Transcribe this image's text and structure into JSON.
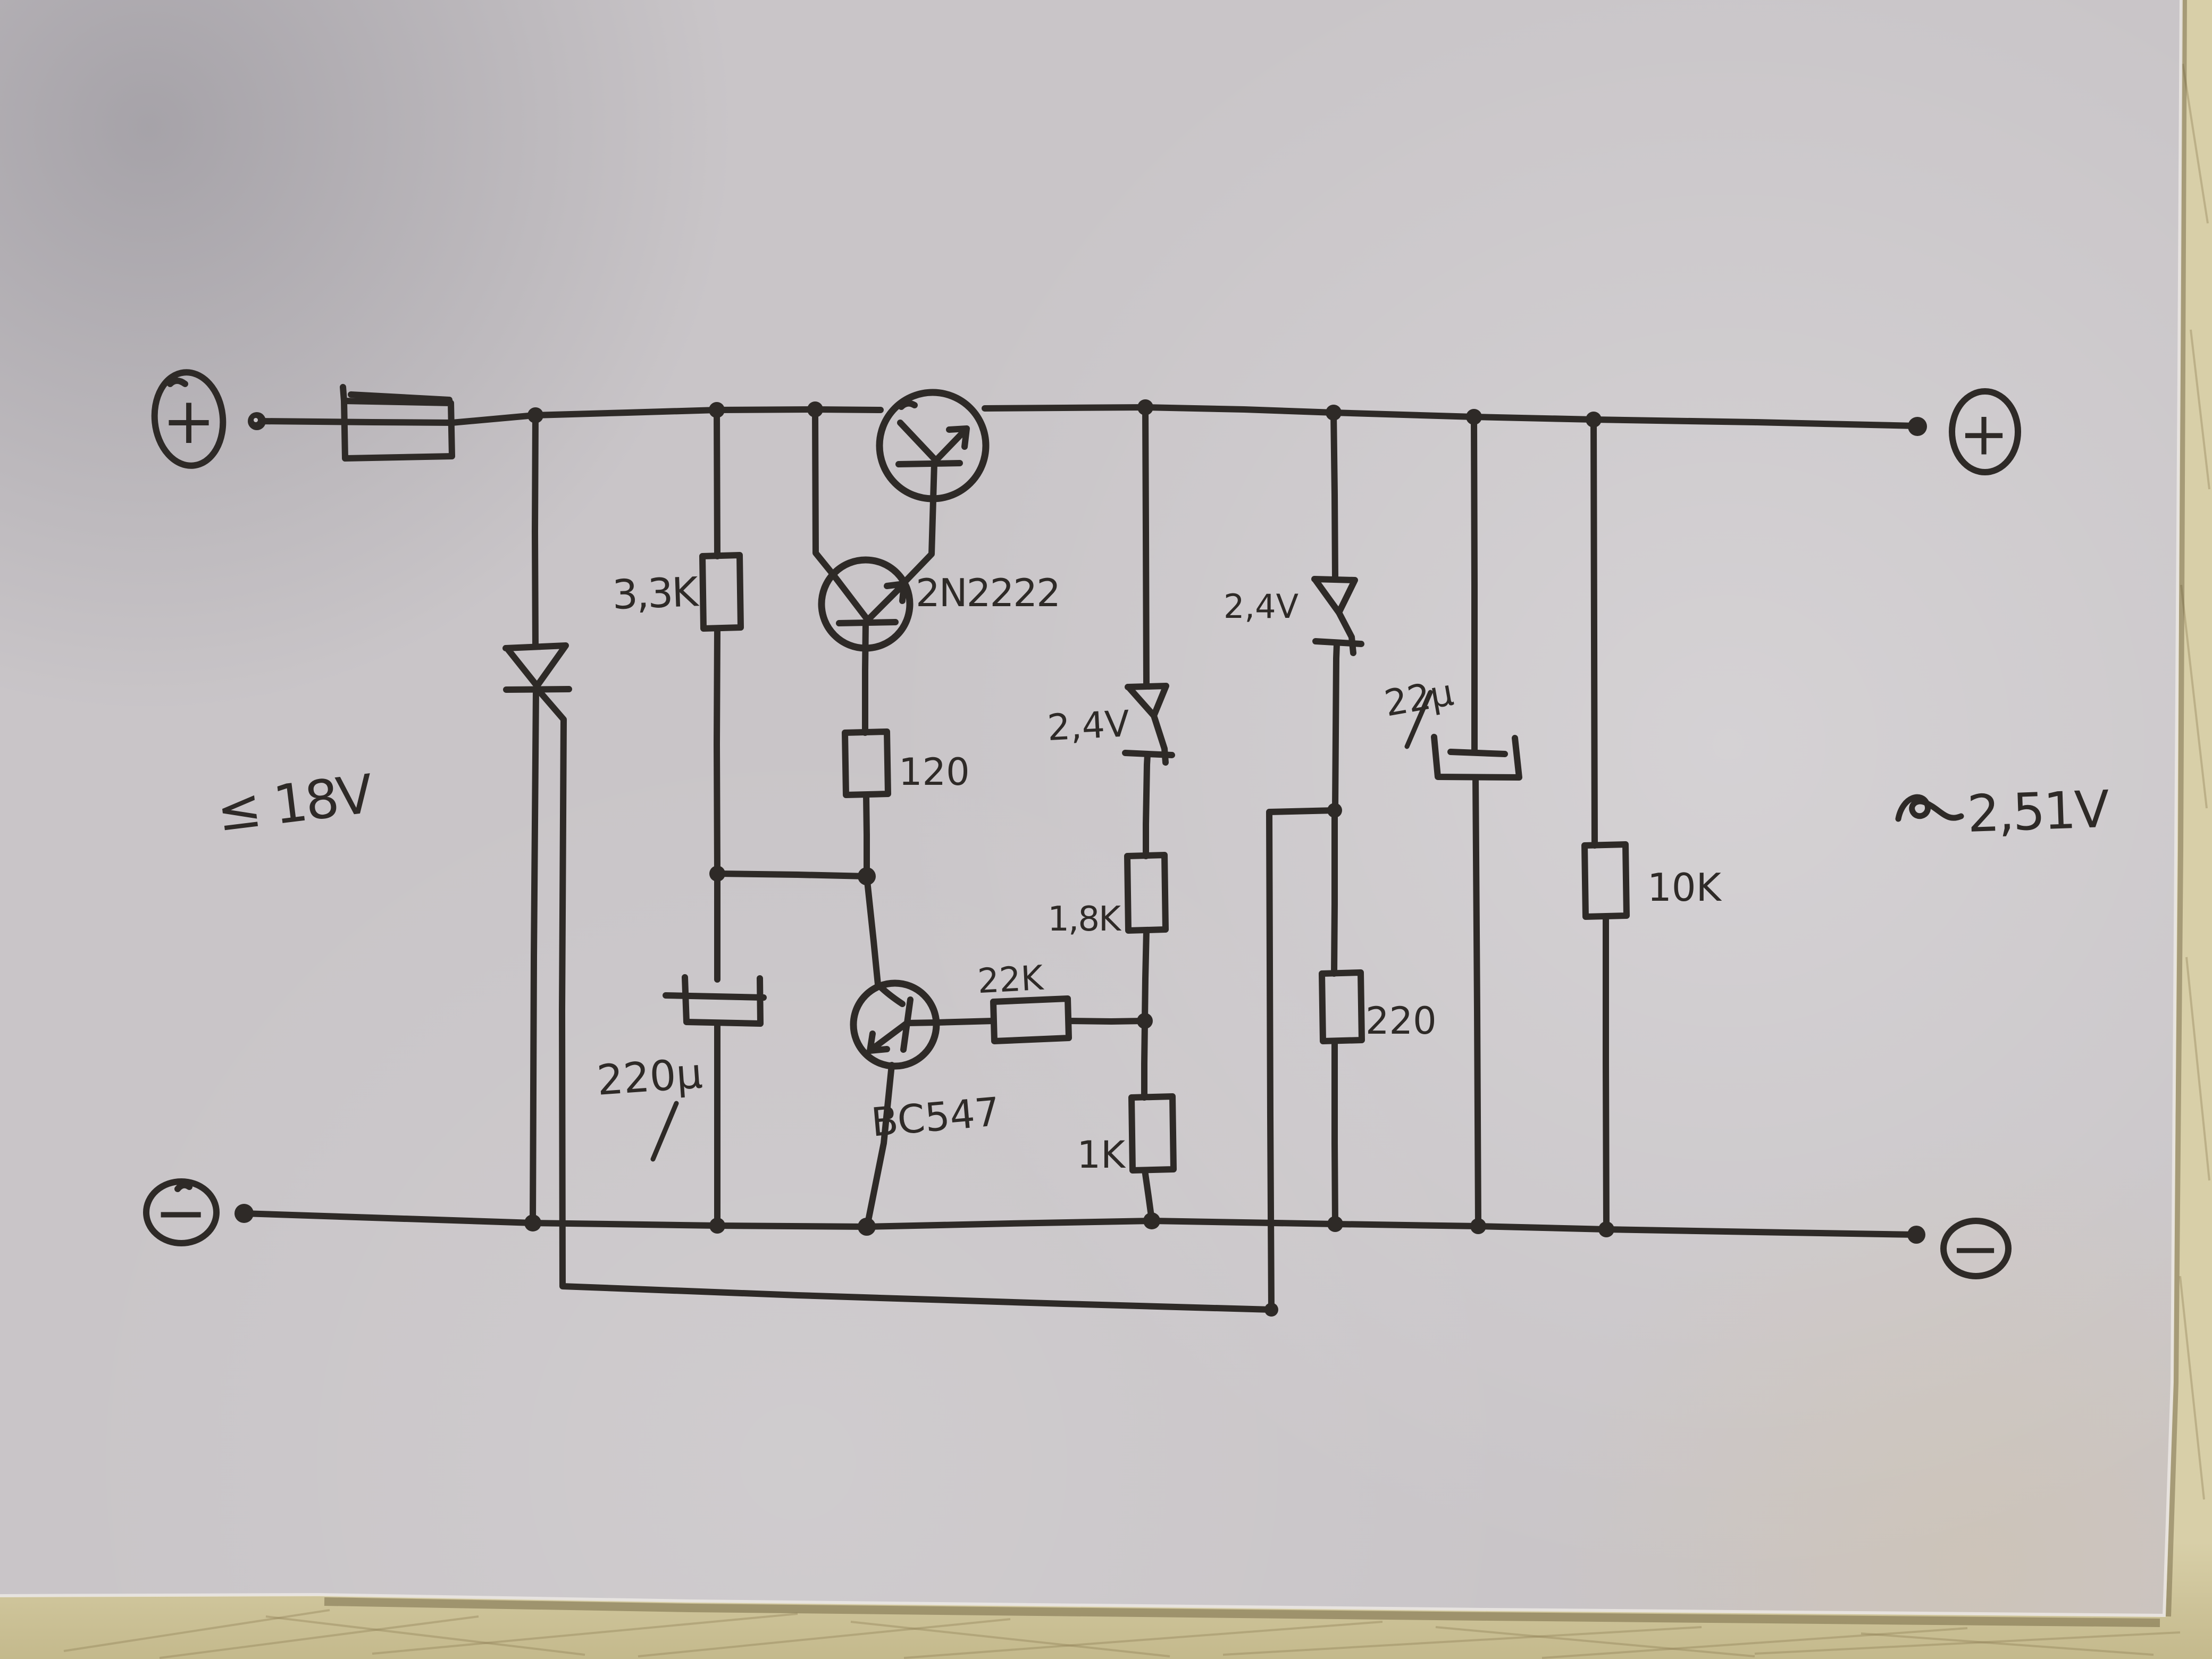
{
  "scene": {
    "type": "photograph",
    "subject": "hand-drawn linear voltage regulator circuit schematic on paper, on a scratched wooden table"
  },
  "colors": {
    "ink": "#2e2a27",
    "paper": "#c9c5c8",
    "paper_highlight": "#e0dcdb",
    "paper_shadow": "#a8a4ab",
    "wood": "#cfc59c",
    "wood_scratch": "#8f7e54"
  },
  "terminals": {
    "top_left": "+",
    "top_right": "+",
    "bottom_left": "−",
    "bottom_right": "−"
  },
  "labels": {
    "input_voltage": "≤ 18V",
    "output_tilde": "~",
    "output_voltage": "2,51V",
    "r_3k3": "3,3K",
    "transistor_2n2222": "2N2222",
    "r_120": "120",
    "zener_mid": "2,4V",
    "zener_right": "2,4V",
    "r_1k8": "1,8K",
    "r_22k": "22K",
    "r_1k": "1K",
    "cap_220u": "220µ",
    "transistor_bc547": "BC547",
    "r_220": "220",
    "cap_22u": "22µ",
    "r_10k": "10K"
  }
}
